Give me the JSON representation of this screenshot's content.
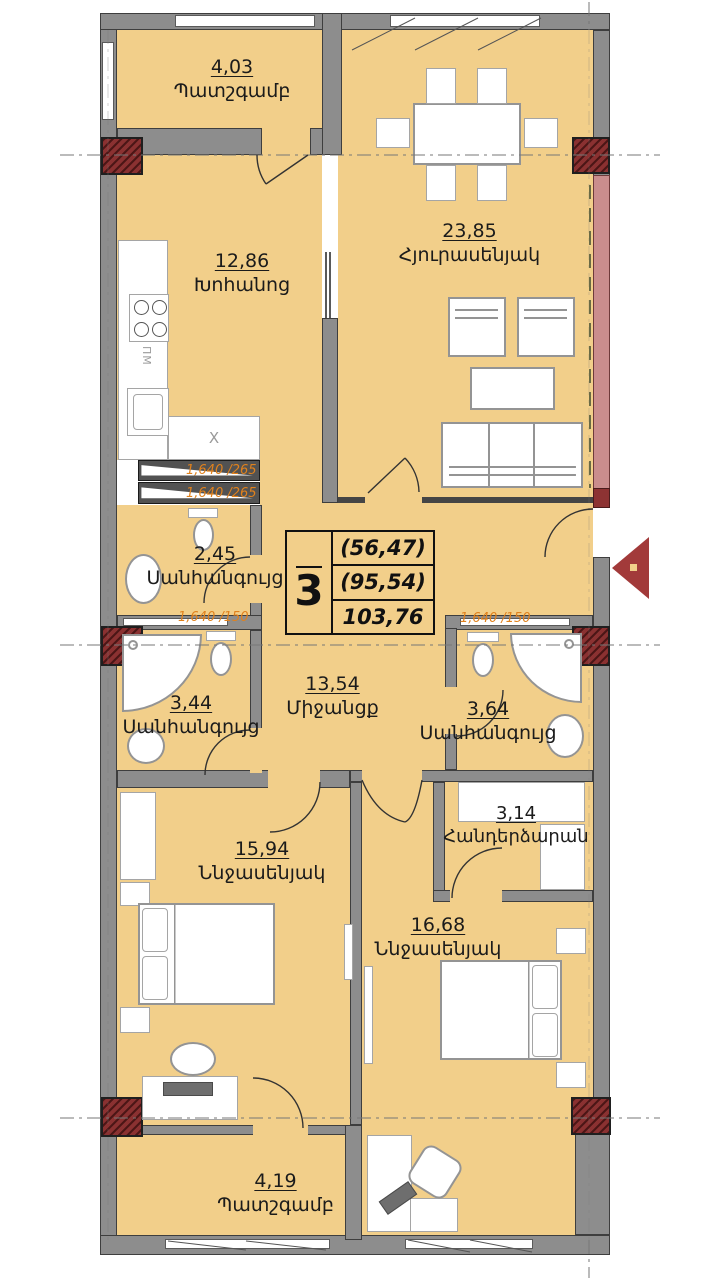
{
  "title": "apartment-floor-plan",
  "stamp": {
    "rooms_count": "3",
    "area_living": "(56,47)",
    "area_sub": "(95,54)",
    "area_total": "103,76"
  },
  "rooms": [
    {
      "area": "4,03",
      "name": "Պատշգամբ"
    },
    {
      "area": "23,85",
      "name": "Հյուրասենյակ"
    },
    {
      "area": "12,86",
      "name": "Խոհանոց"
    },
    {
      "area": "2,45",
      "name": "Սանհանգույց"
    },
    {
      "area": "13,54",
      "name": "Միջանցք"
    },
    {
      "area": "3,44",
      "name": "Սանհանգույց"
    },
    {
      "area": "3,64",
      "name": "Սանհանգույց"
    },
    {
      "area": "3,14",
      "name": "Հանդերձարան"
    },
    {
      "area": "15,94",
      "name": "Ննջասենյակ"
    },
    {
      "area": "16,68",
      "name": "Ննջասենյակ"
    },
    {
      "area": "4,19",
      "name": "Պատշգամբ"
    }
  ],
  "vents": {
    "v265a": "1,640 /265",
    "v265b": "1,640 /265",
    "v150a": "1,640 /150",
    "v150b": "1,640 /150"
  },
  "kitchen": {
    "dishwasher": "ПМ",
    "counter_mark": "X"
  },
  "colors": {
    "floor": "#f2cf8a",
    "wall": "#8d8d8d",
    "wall_outline": "#3e3e3e",
    "column": "#8a3131",
    "pink_wall": "#ca8d8d",
    "orange": "#e0811c",
    "arrow": "#a23a3a"
  }
}
